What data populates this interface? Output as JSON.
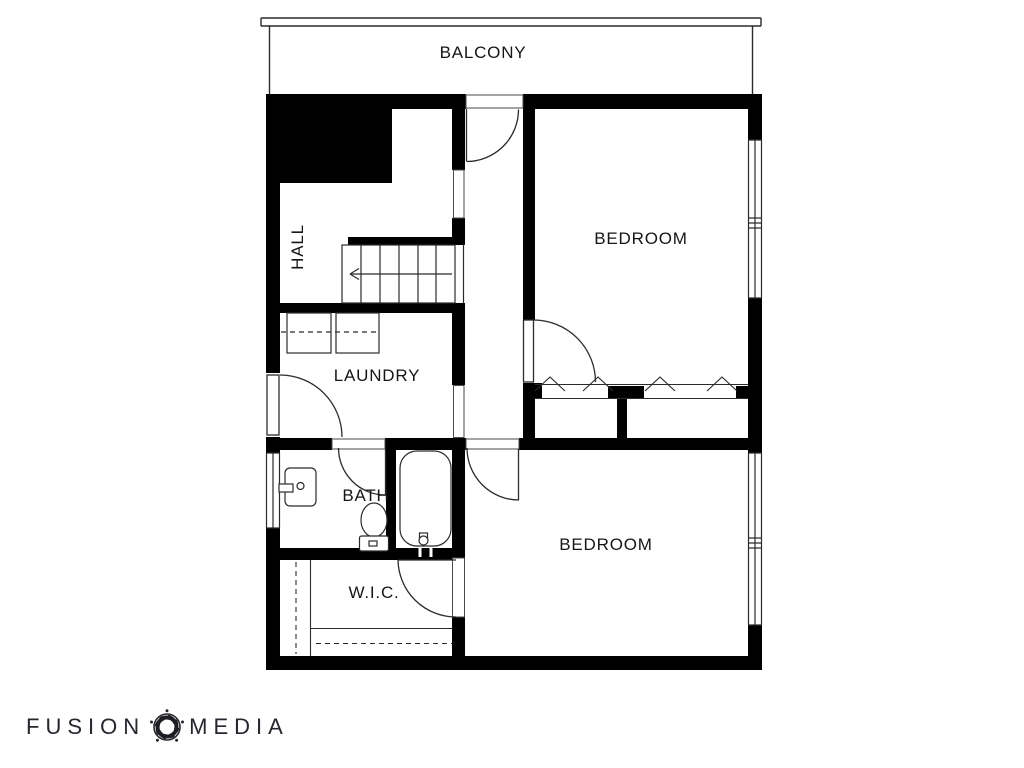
{
  "meta": {
    "type": "floor-plan",
    "background_color": "#ffffff",
    "wall_color": "#000000",
    "line_color": "#2b2b2b",
    "label_color": "#161616",
    "logo_color": "#26262e"
  },
  "rooms": [
    {
      "id": "balcony",
      "label": "BALCONY"
    },
    {
      "id": "bedroom-1",
      "label": "BEDROOM"
    },
    {
      "id": "hall",
      "label": "HALL",
      "rotated": true
    },
    {
      "id": "laundry",
      "label": "LAUNDRY"
    },
    {
      "id": "bath",
      "label": "BATH"
    },
    {
      "id": "wic",
      "label": "W.I.C."
    },
    {
      "id": "bedroom-2",
      "label": "BEDROOM"
    }
  ],
  "fixtures": [
    "stairs-with-direction-arrow",
    "washer",
    "dryer",
    "bathroom-sink",
    "toilet",
    "bathtub",
    "closet-hanging-chevrons",
    "wardrobe-rods-dashed",
    "swing-doors",
    "windows",
    "wall-opening"
  ],
  "logo": {
    "word_left": "FUSION",
    "word_right": "MEDIA",
    "icon": "camera-aperture-icon"
  }
}
